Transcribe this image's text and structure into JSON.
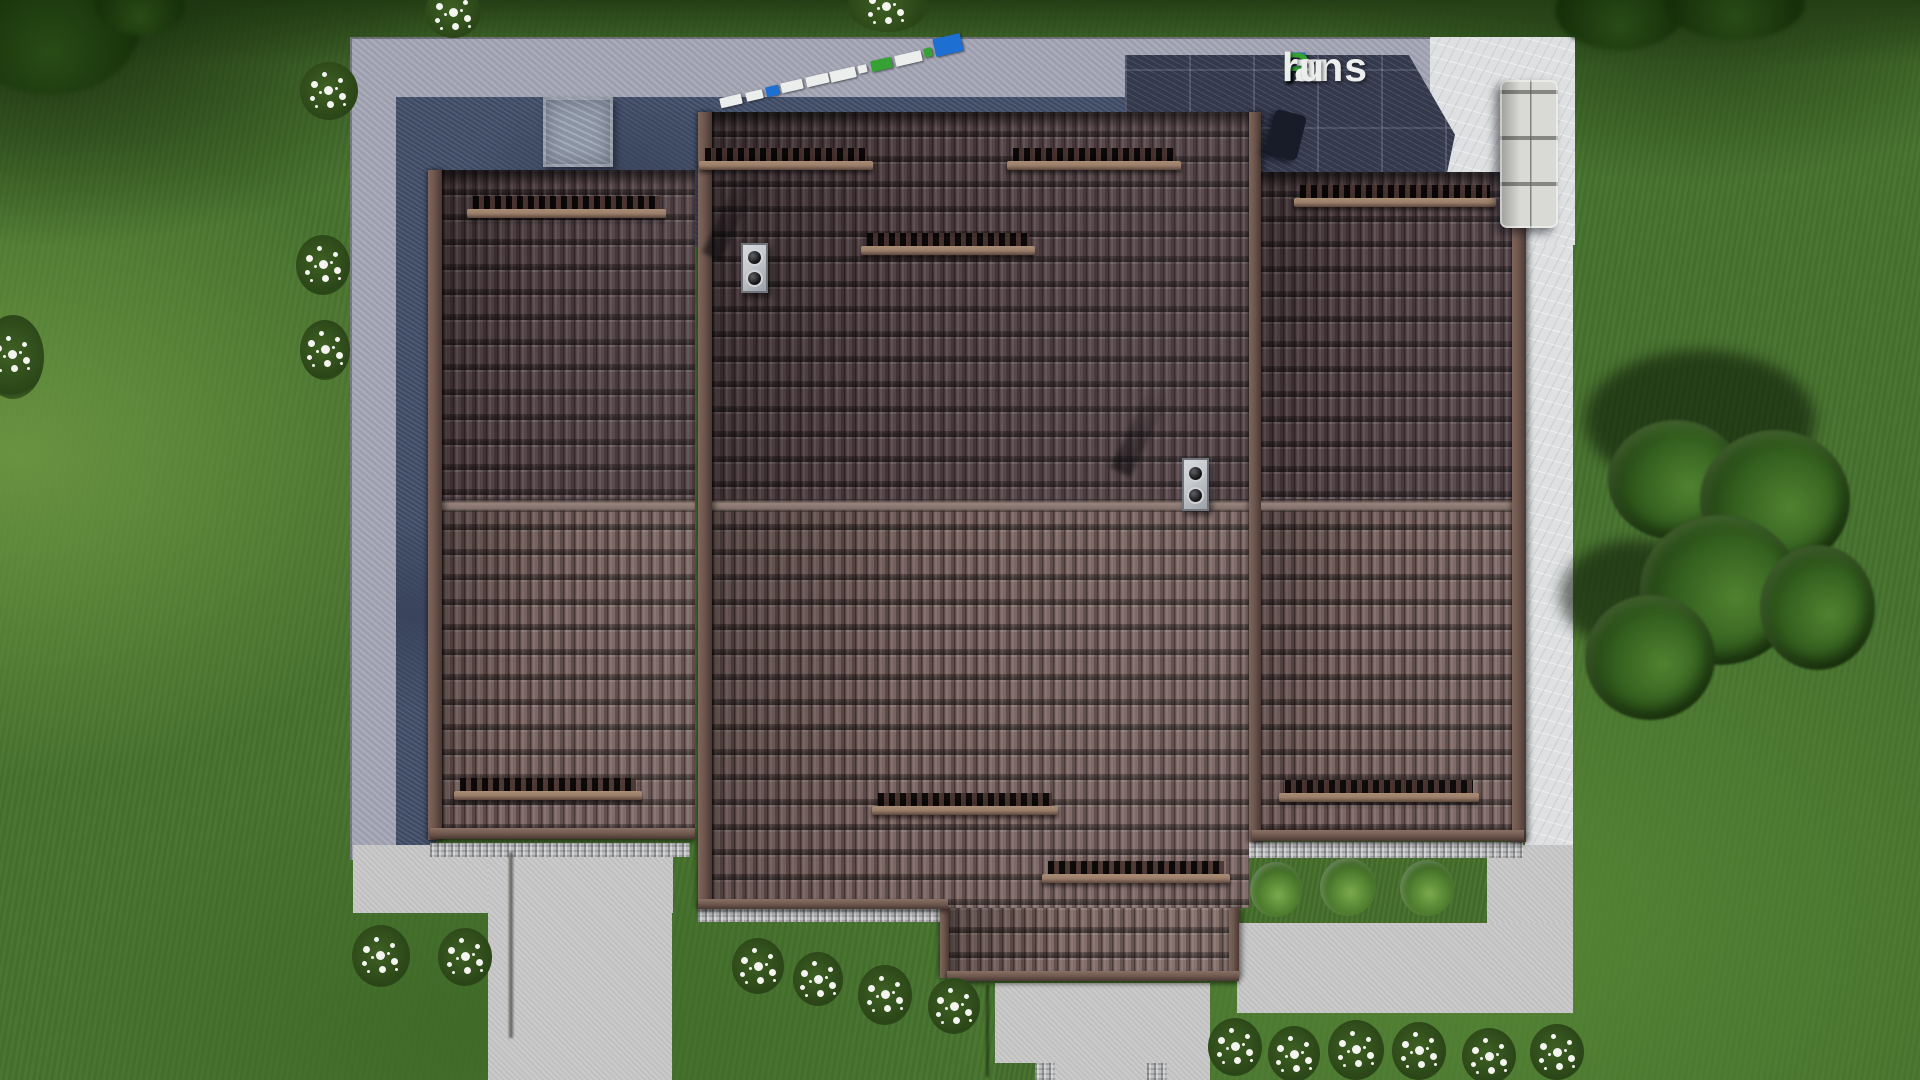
{
  "watermark": {
    "full": "FixPlans.ru",
    "segments": [
      {
        "text": "F",
        "color": "blue"
      },
      {
        "text": "ix",
        "color": "white"
      },
      {
        "text": "P",
        "color": "green"
      },
      {
        "text": "lans",
        "color": "white"
      },
      {
        "text": ".",
        "color": "blue"
      },
      {
        "text": "ru",
        "color": "white"
      }
    ]
  },
  "ground_logo": {
    "description": "small 3D logo slabs lying on the terrace, seen from above",
    "slab_colors": [
      "white",
      "white",
      "blue",
      "white",
      "white",
      "white",
      "white",
      "green",
      "white",
      "green",
      "blue"
    ]
  },
  "palette": {
    "grass-base": "#47722e",
    "grass-dark": "#243f15",
    "grass-deep": "#1a2f0e",
    "grass-light": "#699340",
    "concrete": "#c7c8c7",
    "concrete-cool": "#a6a8b7",
    "band-dark": "#46536e",
    "band-deep": "#39445c",
    "patio-dark": "#3b4157",
    "marble": "#dee0e2",
    "stone": "#96a0b0",
    "roof-upper": "#544347",
    "roof-lower": "#7b6562",
    "roof-ext": "#816b66",
    "trim": "#6d564d",
    "trim-dark": "#4a3833",
    "ridge": "#97837b",
    "guard": "#9c7f6a",
    "chimney": "#c6c9cd",
    "sofa": "#d9d9d6",
    "tree-dark": "#1f3a12",
    "tree-mid": "#35611f",
    "tree-light": "#4f8230",
    "flower": "#f4f5f0",
    "logo-blue": "#1d6fd2",
    "logo-green": "#36a233",
    "logo-white": "#eceded"
  }
}
